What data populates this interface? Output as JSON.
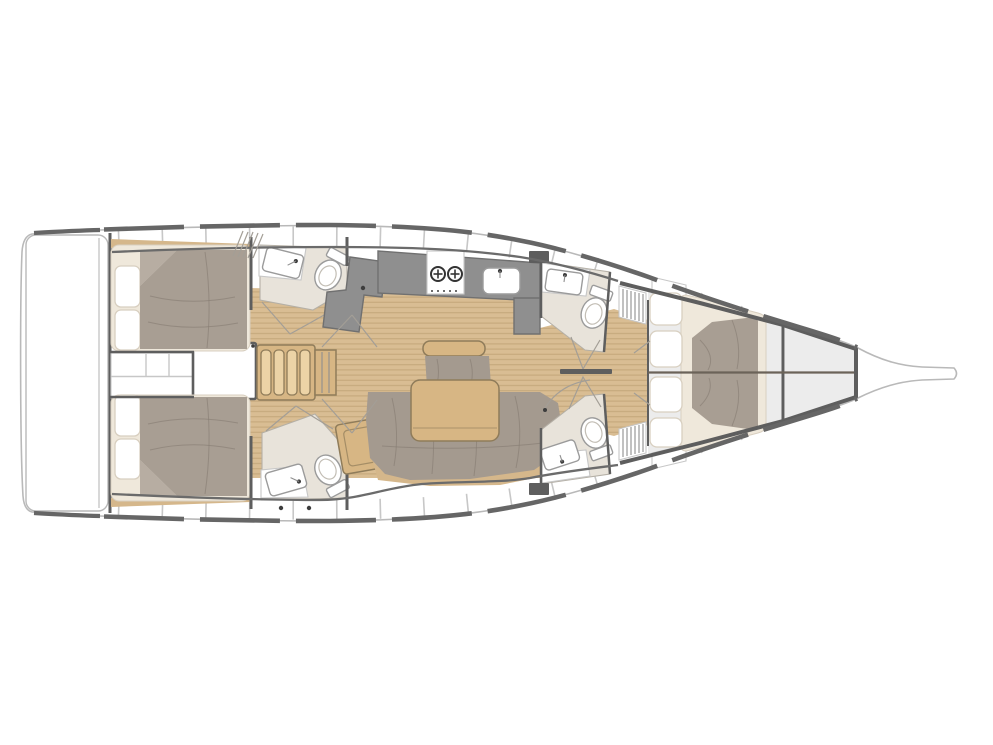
{
  "canvas": {
    "width": 993,
    "height": 745,
    "background": "#ffffff"
  },
  "diagram": {
    "type": "floor-plan",
    "subject": "sailing-yacht-interior-layout",
    "view": "top-down",
    "bow": "right",
    "stern": "left",
    "cabins": 3,
    "heads": 4
  },
  "colors": {
    "hull_stroke": "#b9b9b9",
    "toe_rail": "#666666",
    "wall": "#5e5e5e",
    "wall_line": "#6b6b6b",
    "panel_stroke": "#c7c7c7",
    "tick": "#c7c7c7",
    "cabin_bg": "#ececec",
    "teak": "#d9bd93",
    "teak_line": "#c5a87b",
    "trim": "#d5b78b",
    "wood": "#d7b684",
    "wood_light": "#ecd3a6",
    "wood_stroke": "#8f7c5a",
    "cream": "#efe8db",
    "cream_stroke": "#d8cfc0",
    "upholstery": "#a49a8f",
    "duvet": "#a89e93",
    "duvet_light": "#b7ada2",
    "fold": "#857b71",
    "head_floor": "#e8e3da",
    "head_stroke": "#b5b0a6",
    "counter": "#8f8f8f",
    "counter_stroke": "#707070",
    "fixture_stroke": "#9b9b9b",
    "door_line": "#a39e96",
    "burner": "#333333",
    "dot": "#3d3d3d",
    "seam": "#6b6359"
  },
  "rooms": [
    "swim-platform",
    "aft-cabin-top",
    "aft-cabin-bottom",
    "companionway",
    "salon-dinette",
    "galley",
    "head-mid-top",
    "head-mid-bottom",
    "head-forward-top",
    "head-forward-bottom",
    "forward-owner-cabin",
    "foredeck-anchor-locker",
    "bowsprit"
  ],
  "fixtures": [
    "double-berth-aft-top",
    "double-berth-aft-bottom",
    "island-berth-forward",
    "pillows",
    "companionway-steps",
    "engine-compartment",
    "dining-table",
    "u-shaped-sofa",
    "bench-seat",
    "chaise-seat",
    "galley-counter",
    "stove-two-burner",
    "galley-sink",
    "washbasin-x4",
    "toilet-x4",
    "louvered-lockers",
    "door-swings",
    "deck-hatch"
  ]
}
